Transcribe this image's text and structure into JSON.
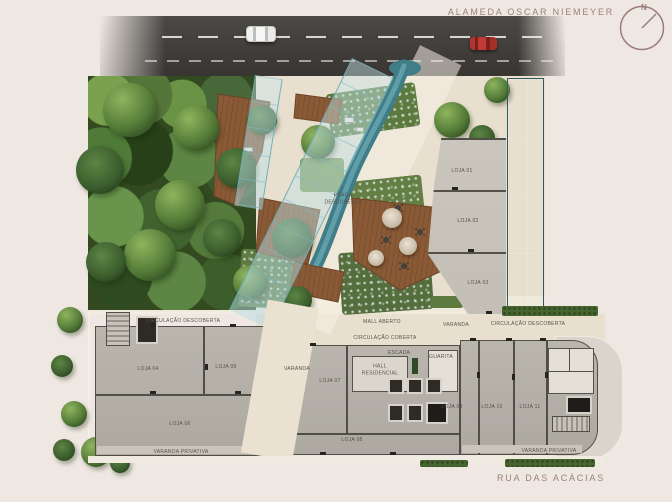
{
  "streets": {
    "top": "ALAMEDA OSCAR NIEMEYER",
    "bottom": "RUA DAS ACÁCIAS"
  },
  "compass": {
    "north": "N"
  },
  "palette": {
    "background": "#efe8e2",
    "street_label": "#9d7f7c",
    "asphalt": "#3e3b38",
    "water": "#5d8b94",
    "glass_canopy": "#bcdfe4",
    "wood_deck": "#8a5a36",
    "forest": "#33491f",
    "concrete": "#b6b2aa",
    "walkway": "#e8dfcf",
    "car_red": "#b23530",
    "car_white": "#f2f1ef"
  },
  "plan": {
    "labels": [
      {
        "name": "label-praca-descoberta",
        "text": "PRAÇA\nDESCOBERTA",
        "x": 343,
        "y": 199
      },
      {
        "name": "label-loja-01",
        "text": "LOJA 01",
        "x": 462,
        "y": 171
      },
      {
        "name": "label-loja-02",
        "text": "LOJA 02",
        "x": 468,
        "y": 221
      },
      {
        "name": "label-loja-03",
        "text": "LOJA 03",
        "x": 478,
        "y": 283
      },
      {
        "name": "label-circulacao-descoberta-left",
        "text": "CIRCULAÇÃO DESCOBERTA",
        "x": 183,
        "y": 321
      },
      {
        "name": "label-mall-aberto",
        "text": "MALL ABERTO",
        "x": 382,
        "y": 322
      },
      {
        "name": "label-circulacao-coberta",
        "text": "CIRCULAÇÃO COBERTA",
        "x": 385,
        "y": 338
      },
      {
        "name": "label-varanda-west",
        "text": "VARANDA",
        "x": 297,
        "y": 369
      },
      {
        "name": "label-varanda-east",
        "text": "VARANDA",
        "x": 456,
        "y": 325
      },
      {
        "name": "label-circulacao-descoberta-right",
        "text": "CIRCULAÇÃO DESCOBERTA",
        "x": 528,
        "y": 324
      },
      {
        "name": "label-escada",
        "text": "ESCADA",
        "x": 399,
        "y": 353
      },
      {
        "name": "label-hall-residencial",
        "text": "HALL\nRESIDENCIAL",
        "x": 380,
        "y": 370
      },
      {
        "name": "label-guarita",
        "text": "GUARITA",
        "x": 441,
        "y": 357
      },
      {
        "name": "label-loja-04",
        "text": "LOJA 04",
        "x": 148,
        "y": 369
      },
      {
        "name": "label-loja-05",
        "text": "LOJA 05",
        "x": 226,
        "y": 367
      },
      {
        "name": "label-loja-06",
        "text": "LOJA 06",
        "x": 180,
        "y": 424
      },
      {
        "name": "label-varanda-privativa-left",
        "text": "VARANDA PRIVATIVA",
        "x": 181,
        "y": 452
      },
      {
        "name": "label-loja-07",
        "text": "LOJA 07",
        "x": 330,
        "y": 381
      },
      {
        "name": "label-loja-08",
        "text": "LOJA 08",
        "x": 352,
        "y": 440
      },
      {
        "name": "label-loja-09",
        "text": "LOJA 09",
        "x": 452,
        "y": 407
      },
      {
        "name": "label-loja-10",
        "text": "LOJA 10",
        "x": 492,
        "y": 407
      },
      {
        "name": "label-loja-11",
        "text": "LOJA 11",
        "x": 530,
        "y": 407
      },
      {
        "name": "label-varanda-privativa-right",
        "text": "VARANDA PRIVATIVA",
        "x": 549,
        "y": 451
      }
    ]
  }
}
